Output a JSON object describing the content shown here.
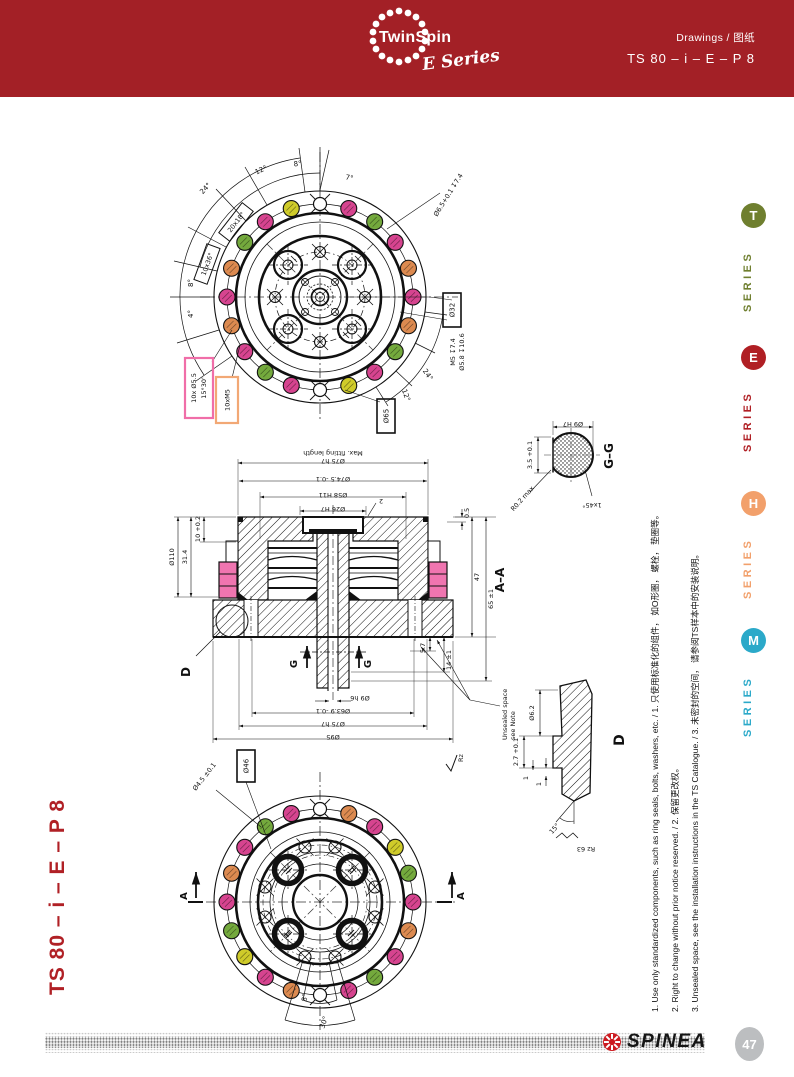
{
  "header": {
    "bg": "#A32026",
    "brand": "TwinSpin",
    "brand_sub": "E Series",
    "doc_type": "Drawings / 图纸",
    "model": "TS 80 – i – E – P 8"
  },
  "series_rail": {
    "items": [
      {
        "letter": "T",
        "label": "SERIES",
        "color": "#6F7F2F"
      },
      {
        "letter": "E",
        "label": "SERIES",
        "color": "#B01F24"
      },
      {
        "letter": "H",
        "label": "SERIES",
        "color": "#F2A06B"
      },
      {
        "letter": "M",
        "label": "SERIES",
        "color": "#2BA9C9"
      }
    ]
  },
  "side_title": "TS 80 – i – E – P 8",
  "footnotes": [
    "1. Use only standardized components, such as ring seals, bolts, washers, etc. / 1. 只使用标准化的组件， 如O形圈， 螺栓， 垫圈等。",
    "2. Right to change without prior notice reserved. / 2. 保留更改权。",
    "3. Unsealed space, see the installation instructions in the TS Catalogue. / 3. 未密封的空间， 请参阅TS样本中的安装说明。"
  ],
  "footer": {
    "brand": "SPINEA",
    "page": "47",
    "badge_color": "#BCBEC0",
    "accent": "#CC1A20"
  },
  "drawing": {
    "colors": {
      "magenta": "#D6448F",
      "orange": "#DC8A50",
      "green": "#74A93D",
      "yellow": "#CFCB2A",
      "seal": "#F075B0",
      "pink_box": "#F06EA8",
      "orange_box": "#F2A875"
    },
    "dot_rings": {
      "top": {
        "pattern": [
          "x",
          "m",
          "g",
          "m",
          "o",
          "m",
          "o",
          "g",
          "m",
          "y",
          "x",
          "m",
          "g",
          "m",
          "o",
          "m",
          "o",
          "g",
          "m",
          "y"
        ]
      },
      "bottom": {
        "pattern": [
          "x",
          "o",
          "m",
          "y",
          "g",
          "m",
          "o",
          "m",
          "g",
          "m",
          "x",
          "o",
          "m",
          "y",
          "g",
          "m",
          "o",
          "m",
          "g",
          "m"
        ]
      }
    },
    "top_view": {
      "labels": {
        "dia65": "Ø65",
        "dia32": "Ø32",
        "holes1": "10x Ø5.5",
        "holes1b": "15°30'",
        "holes2": "10xM5",
        "pitch1": "20x18°",
        "pitch2": "10x36°",
        "a24": "24°",
        "a12": "12°",
        "a8": "8°",
        "a7": "7°",
        "a8b": "8°",
        "a4": "4°",
        "a24b": "24°",
        "a12b": "12°",
        "hole_spec": "Ø6.5+0.1 ↧7.4",
        "thread_spec": "M5 ↧7.4",
        "cbore_spec": "Ø5.8 ↧10.6"
      }
    },
    "section": {
      "title": "A–A",
      "top_dims": {
        "fit": "Max. fitting length",
        "d75": "Ø75 h7",
        "d745": "Ø74.5 -0.1",
        "d58": "Ø58 H11",
        "d26": "Ø26 H7",
        "t2": "2",
        "t05": "0.5"
      },
      "left_dims": {
        "l1": "31.4",
        "l2": "10 +0.2",
        "l3": "Ø110"
      },
      "right_dims": {
        "r47": "47",
        "r65": "65 ±1",
        "r57": "5.7",
        "r14": "14 ±1"
      },
      "bottom_dims": {
        "d9": "Ø9 h6",
        "d639": "Ø63.9 -0.1",
        "d75b": "Ø75 h7",
        "d95": "Ø95"
      },
      "cut_g": "G",
      "detail_d": "D",
      "note1": "Unsealed space",
      "note2": "see Note"
    },
    "detail_gg": {
      "title": "G–G",
      "d1": "Ø9 H7",
      "d2": "3.5 +0.1",
      "d3": "R0.2 max",
      "d4": "1x45°"
    },
    "detail_d": {
      "title": "D",
      "d1": "Ø6.2",
      "d2": "2.7 +0.1",
      "d3": "1",
      "d4": "1",
      "d5": "15°",
      "d6": "Rz 63"
    },
    "bottom_view": {
      "labels": {
        "dia46": "Ø46",
        "hole": "Ø4.5 ±0.1",
        "secA": "A",
        "a8": "8°",
        "a30": "30°",
        "rz": "Rz"
      }
    }
  }
}
